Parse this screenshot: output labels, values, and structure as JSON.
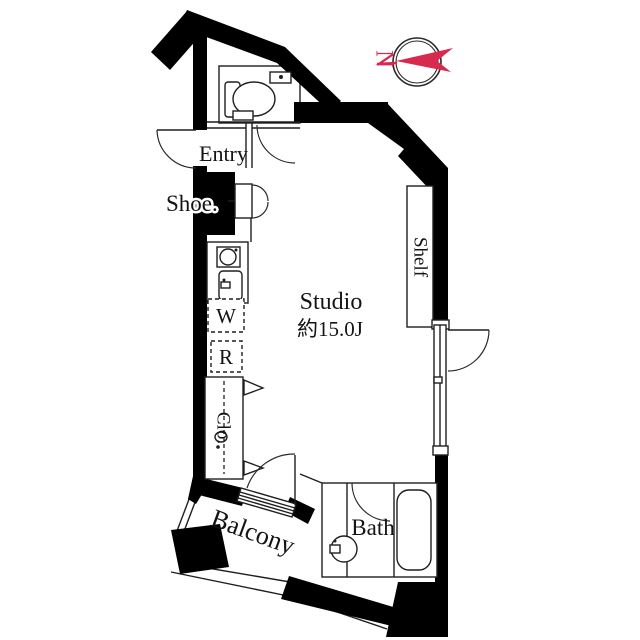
{
  "plan": {
    "type": "floor-plan",
    "labels": {
      "entry": "Entry",
      "shoe": "Shoe.",
      "washer": "W",
      "fridge": "R",
      "closet": "Clo.",
      "studio_name": "Studio",
      "studio_size": "約15.0J",
      "shelf": "Shelf",
      "balcony": "Balcony",
      "bath": "Bath"
    },
    "compass": {
      "letter": "N",
      "accent_color": "#d8294f"
    },
    "colors": {
      "wall": "#000000",
      "line": "#1f1f1f",
      "background": "#ffffff"
    }
  }
}
